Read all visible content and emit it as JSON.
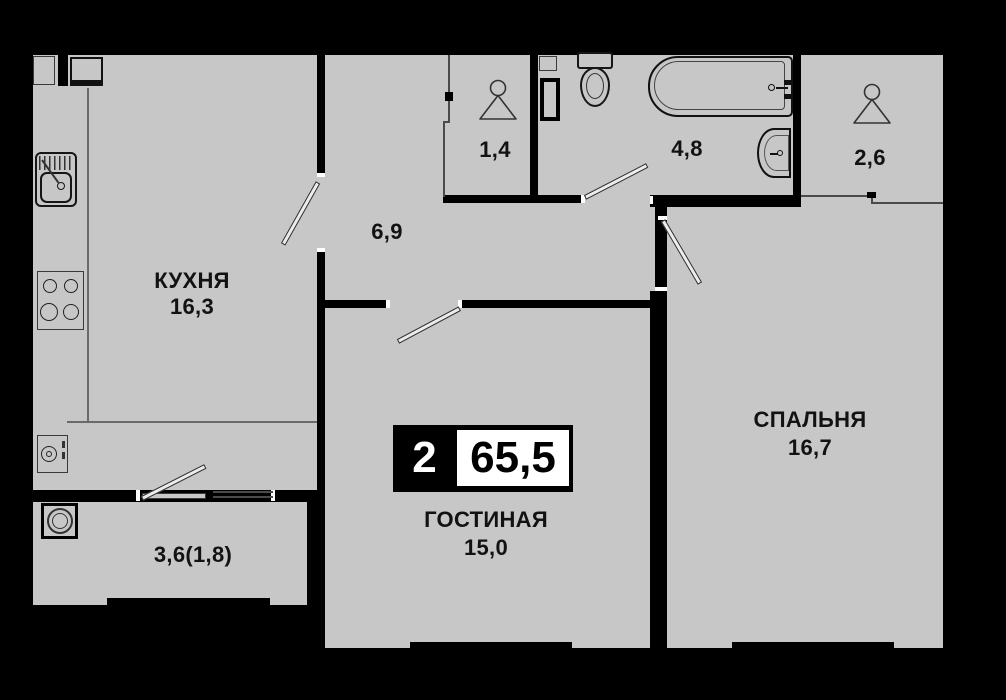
{
  "plan": {
    "badge": {
      "rooms": "2",
      "area": "65,5"
    },
    "rooms": {
      "kitchen": {
        "name": "КУХНЯ",
        "area": "16,3"
      },
      "hallway": {
        "area": "6,9"
      },
      "wardrobe": {
        "area": "1,4"
      },
      "bathroom": {
        "area": "4,8"
      },
      "closet": {
        "area": "2,6"
      },
      "living": {
        "name": "ГОСТИНАЯ",
        "area": "15,0"
      },
      "bedroom": {
        "name": "СПАЛЬНЯ",
        "area": "16,7"
      },
      "balcony": {
        "area": "3,6(1,8)"
      }
    },
    "colors": {
      "floor": "#c7c7c7",
      "wall": "#000000",
      "text": "#121212",
      "background": "#000000"
    }
  }
}
